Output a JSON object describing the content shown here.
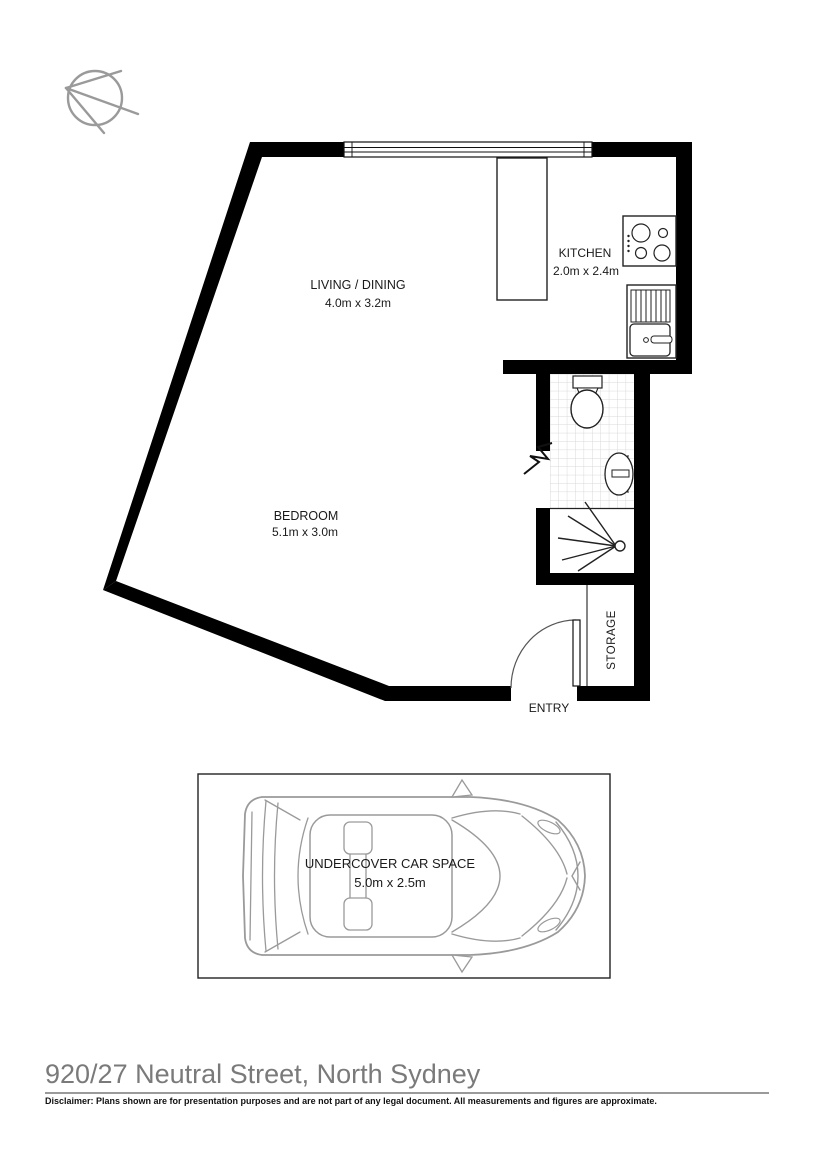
{
  "page": {
    "background": "#ffffff",
    "wall_color": "#000000",
    "fixture_line_color": "#222222",
    "car_outline_color": "#9a9a9a",
    "tile_line_color": "#d9d9d9"
  },
  "compass": {
    "icon": "compass-north-icon",
    "color": "#9a9a9a"
  },
  "floorplan": {
    "rooms": [
      {
        "id": "living_dining",
        "name": "LIVING / DINING",
        "dimensions": "4.0m x 3.2m"
      },
      {
        "id": "kitchen",
        "name": "KITCHEN",
        "dimensions": "2.0m x 2.4m"
      },
      {
        "id": "bedroom",
        "name": "BEDROOM",
        "dimensions": "5.1m x 3.0m"
      },
      {
        "id": "storage",
        "name": "STORAGE"
      },
      {
        "id": "entry",
        "name": "ENTRY"
      }
    ],
    "fixtures": [
      "window",
      "kitchen-island",
      "cooktop",
      "kitchen-sink",
      "toilet",
      "bathroom-basin",
      "shower",
      "entry-door",
      "wall-break"
    ]
  },
  "carspace": {
    "name": "UNDERCOVER CAR SPACE",
    "dimensions": "5.0m x 2.5m",
    "icon": "car-top-view-icon"
  },
  "footer": {
    "title": "920/27 Neutral Street, North Sydney",
    "disclaimer": "Disclaimer: Plans shown are for presentation purposes and are not part of any legal document. All measurements and figures are approximate.",
    "title_color": "#7a7a7a"
  }
}
